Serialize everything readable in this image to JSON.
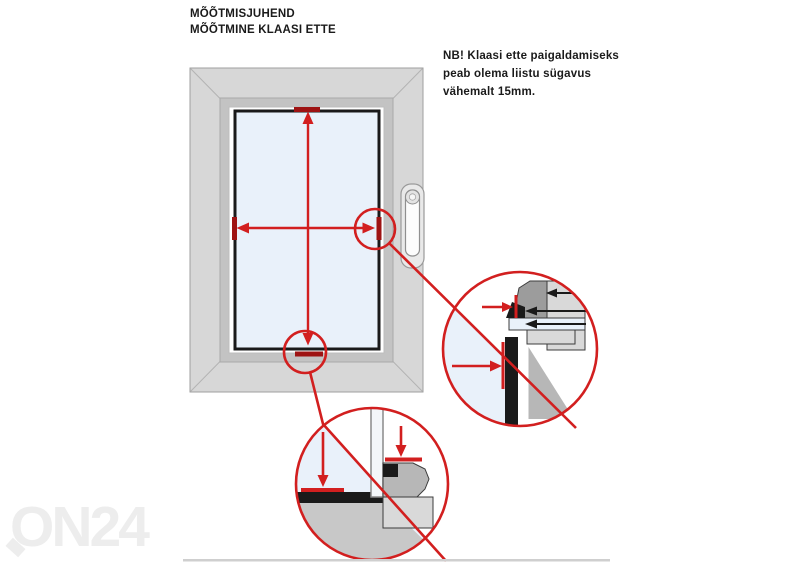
{
  "page": {
    "title_line1": "MÕÕTMISJUHEND",
    "title_line2": "MÕÕTMINE KLAASI ETTE",
    "note_line1": "NB! Klaasi ette paigaldamiseks",
    "note_line2": "peab olema liistu sügavus",
    "note_line3": "vähemalt 15mm.",
    "watermark": "ON24"
  },
  "palette": {
    "red": "#d21f1f",
    "dark_red": "#9e1313",
    "glass_blue": "#e9f1fa",
    "frame_gray": "#d7d7d7",
    "bevel_gray": "#c3c3c3",
    "sash_white": "#ffffff",
    "section_dark_gray": "#9c9c9c",
    "section_mid_gray": "#b7b7b7",
    "section_light_gray": "#d9d9d9",
    "front_frame_gray": "#c8c8c8",
    "line_black": "#1a1a1a",
    "outline_gray": "#9f9f9f",
    "watermark_gray": "#ededed",
    "divider_gray": "#cfcfcf"
  },
  "icons": {
    "window": "window-front-view",
    "handle": "window-handle",
    "height_arrow": "vertical-measure-arrow",
    "width_arrow": "horizontal-measure-arrow",
    "side_detail": "glazing-bead-side-cross-section",
    "bottom_detail": "glazing-bead-bottom-cross-section"
  }
}
